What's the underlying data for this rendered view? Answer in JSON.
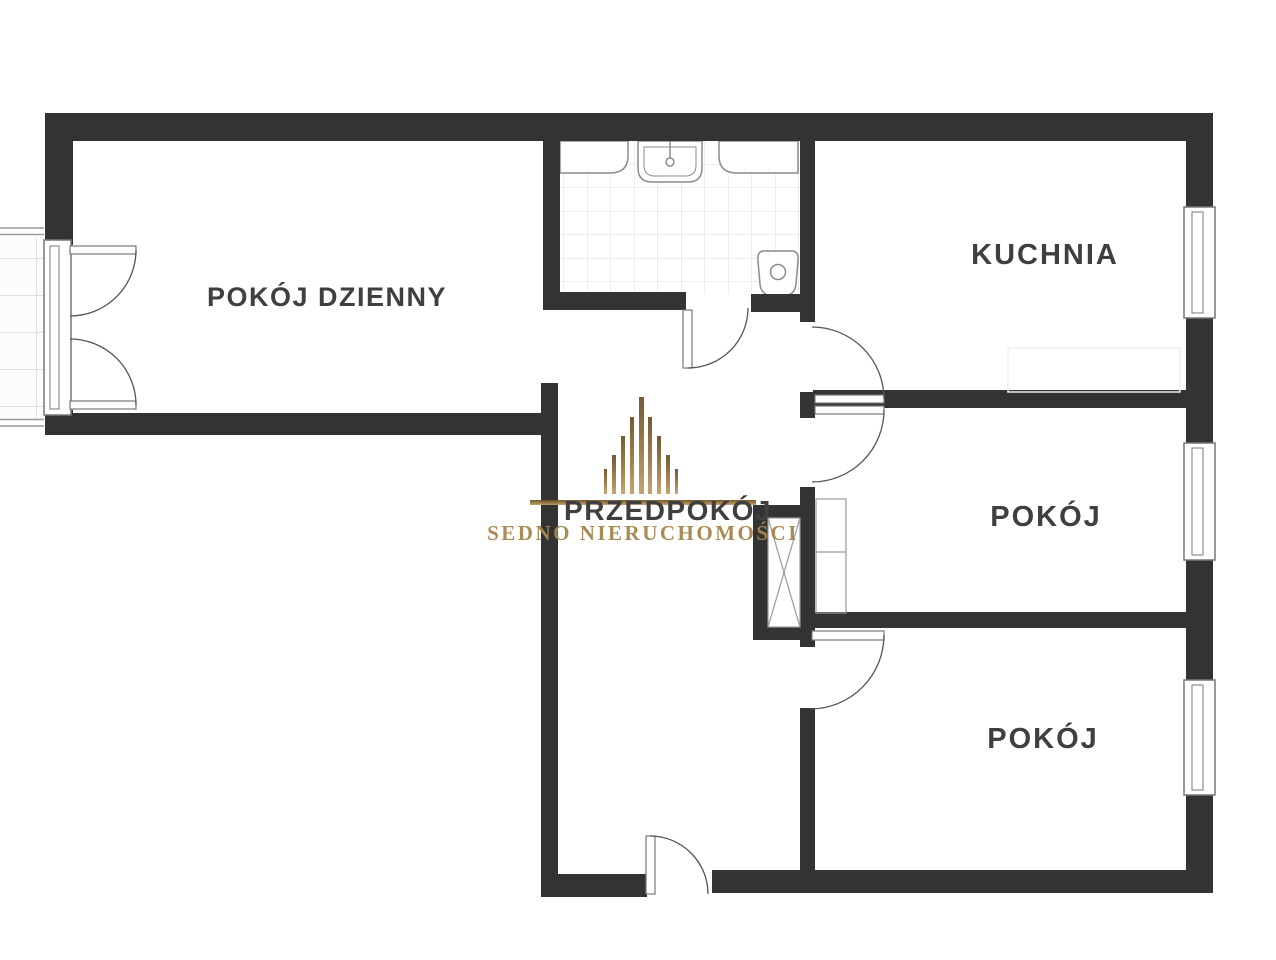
{
  "page": {
    "title": "Rzut mieszkania"
  },
  "rooms": {
    "living_room": {
      "label": "POKÓJ DZIENNY"
    },
    "kitchen": {
      "label": "KUCHNIA"
    },
    "hallway": {
      "label": "PRZEDPOKÓJ"
    },
    "room_middle": {
      "label": "POKÓJ"
    },
    "room_bottom": {
      "label": "POKÓJ"
    }
  },
  "watermark": {
    "brand": "SEDNO NIERUCHOMOŚCI"
  },
  "colors": {
    "wall": "#333333",
    "label": "#3f3f3f",
    "gold_text": "#a6854d",
    "tile_line": "#dcdcdc",
    "balcony_tile_line": "#cfcfcf",
    "fixture_line": "#8c8c8c",
    "door_line": "#555555",
    "frame_line": "#777777",
    "furniture_line": "#999999"
  }
}
